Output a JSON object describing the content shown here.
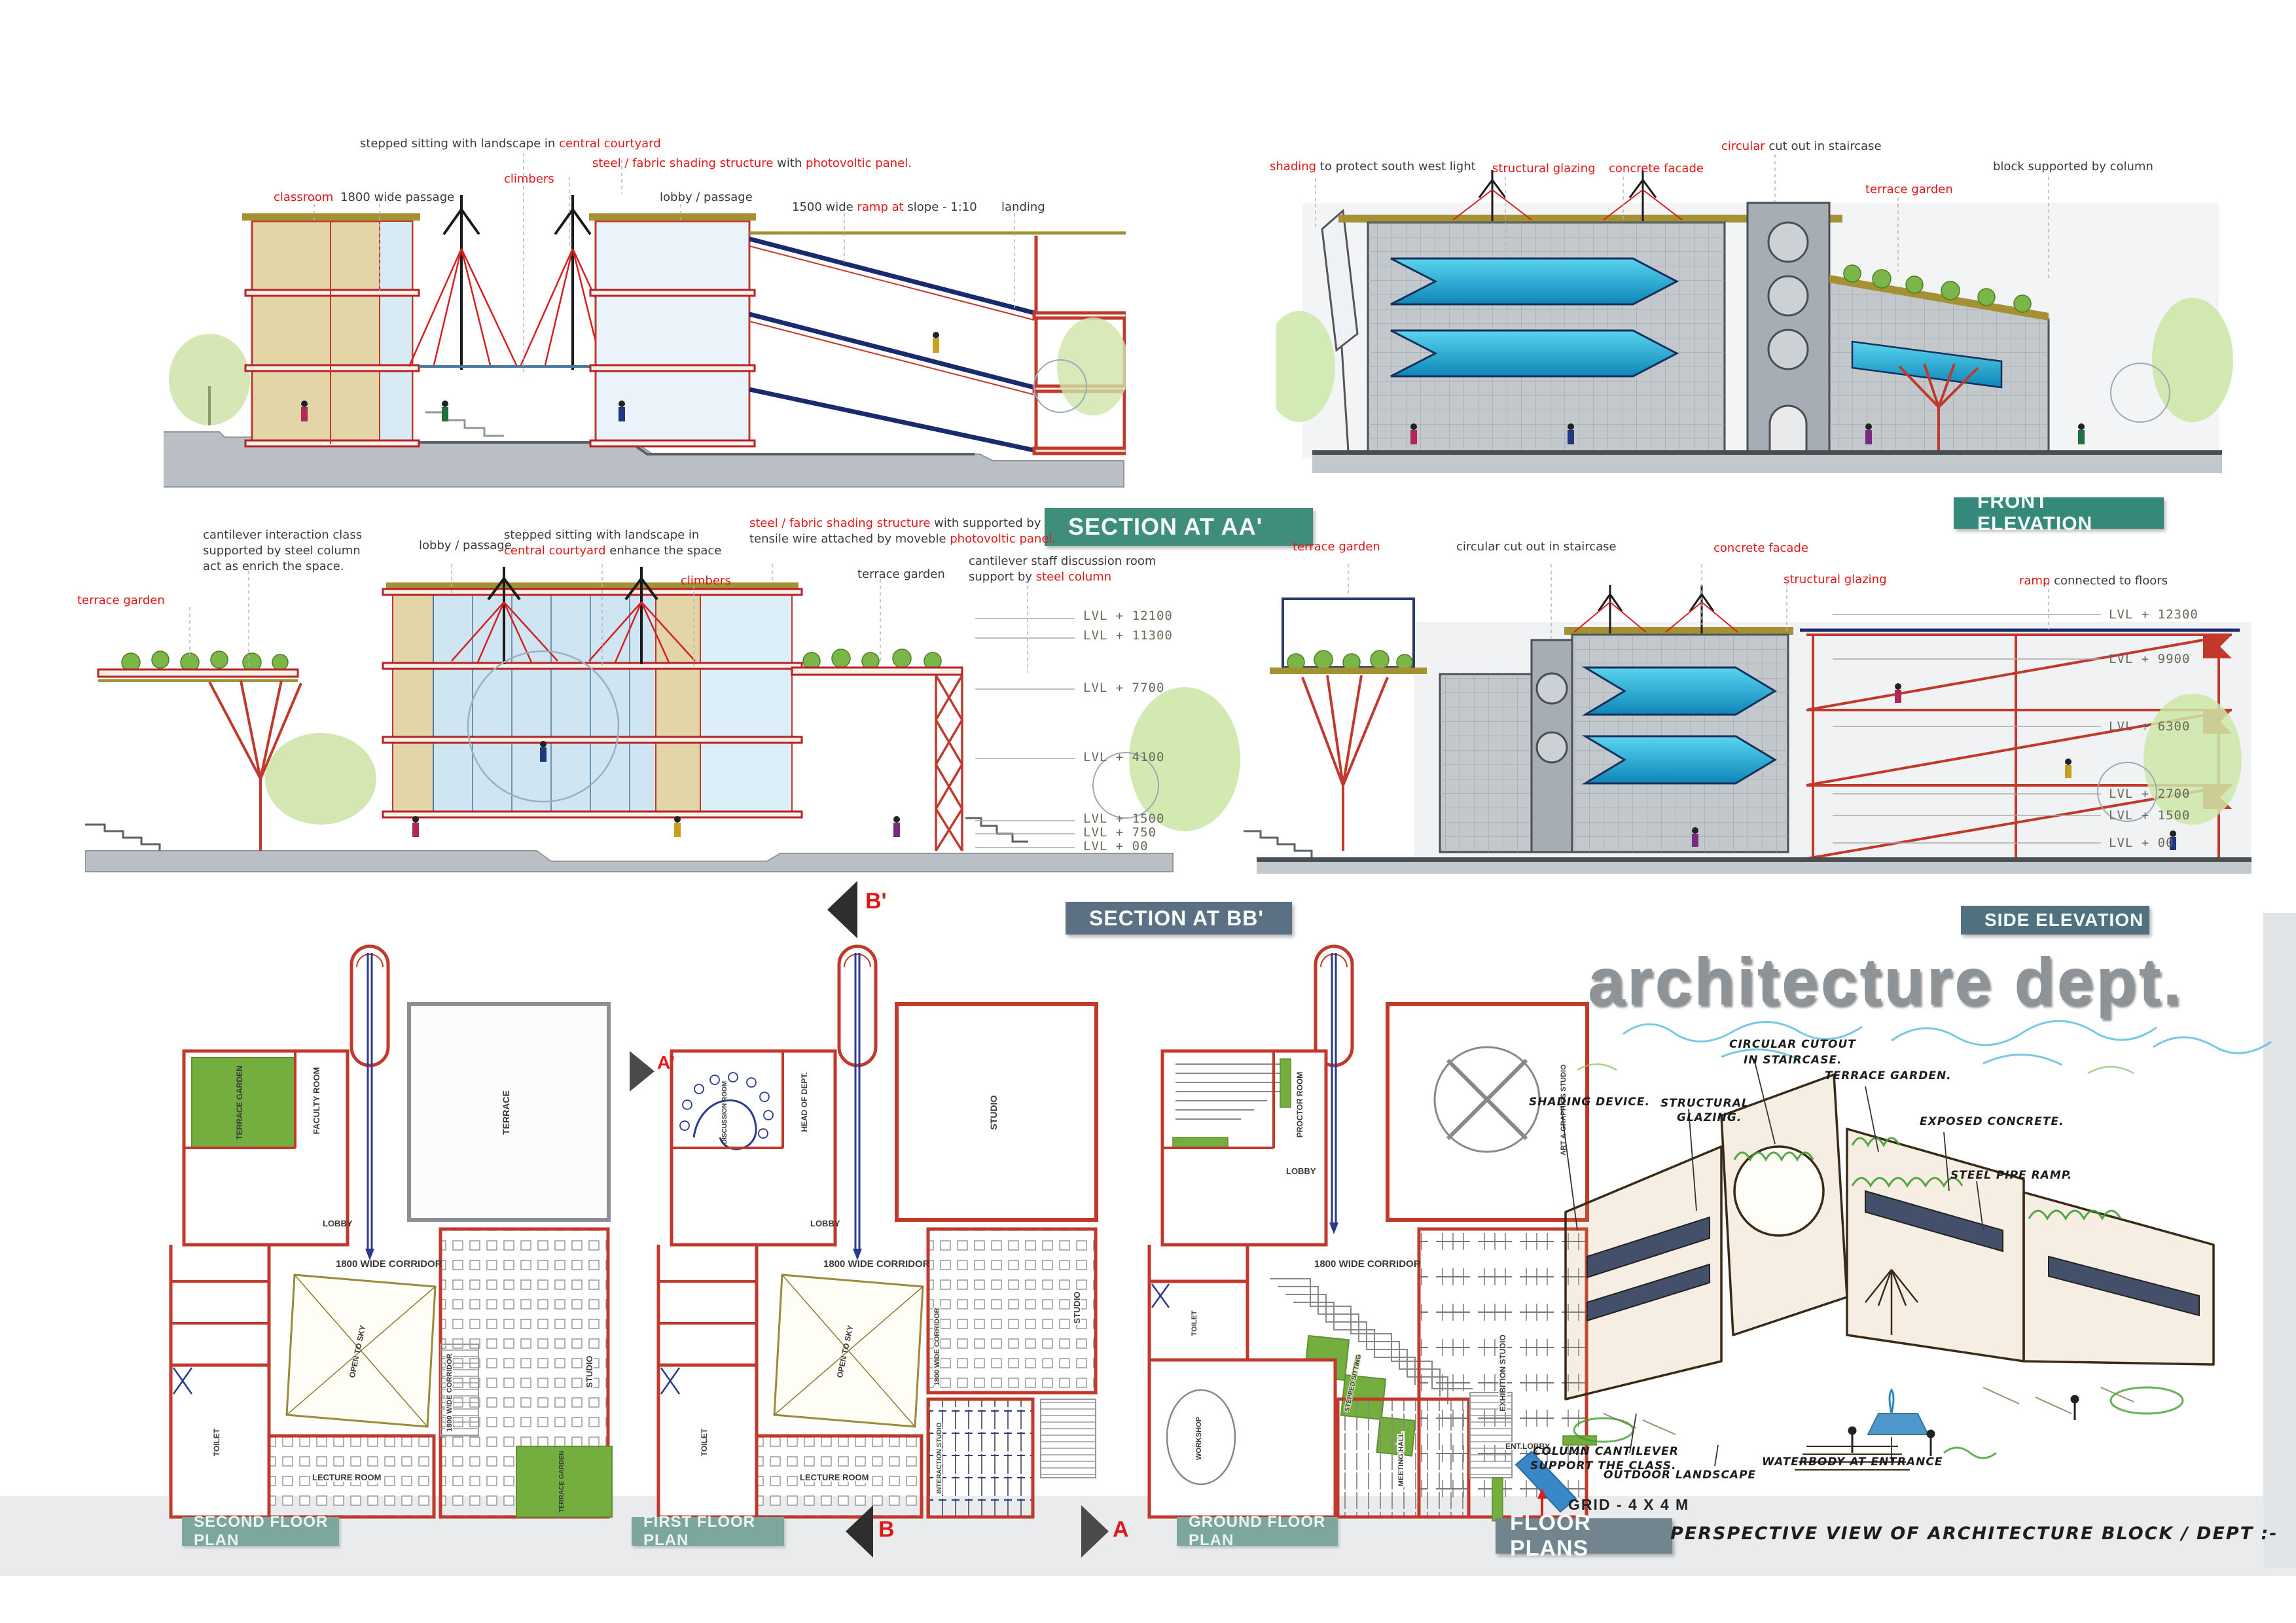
{
  "banners": {
    "section_aa": "SECTION AT AA'",
    "front_elevation": "FRONT ELEVATION",
    "section_bb": "SECTION AT BB'",
    "side_elevation": "SIDE ELEVATION",
    "floor_plans": "FLOOR PLANS"
  },
  "watermark": "architecture dept.",
  "colors": {
    "annotation_red": "#e01818",
    "wall_red": "#c0392b",
    "glazing_cyan": "#2bb4dc",
    "banner_teal": "#3f8e7c",
    "banner_slate": "#5b7183",
    "garden_green": "#74ae3e"
  },
  "section_aa": {
    "ann": {
      "stepped_pre": "stepped sitting with landscape in ",
      "stepped_red": "central courtyard",
      "steel_red1": "steel / fabric shading  structure",
      "steel_mid": " with ",
      "steel_red2": "photovoltic panel.",
      "climbers": "climbers",
      "classroom": "classroom",
      "passage": "1800 wide passage",
      "lobby": "lobby / passage",
      "ramp_pre": "1500 wide ",
      "ramp_red": "ramp at",
      "ramp_post": " slope - 1:10",
      "landing": "landing"
    }
  },
  "front_elevation": {
    "ann": {
      "shading_red": "shading",
      "shading_post": " to protect south west light",
      "structural_glazing": "structural glazing",
      "concrete_facade": "concrete facade",
      "circular_red": "circular",
      "circular_post": " cut out in staircase",
      "terrace_garden": "terrace garden",
      "block": "block supported by column"
    }
  },
  "section_bb": {
    "ann": {
      "cant1": "cantilever interaction class",
      "cant2": "supported by steel column",
      "cant3": "act as enrich the space.",
      "lobby": "lobby / passage",
      "stepped1": "stepped sitting with landscape in",
      "stepped_red": "central courtyard",
      "stepped_post": " enhance the space",
      "steel_red1": "steel / fabric shading  structure",
      "steel_mid": " with supported by",
      "steel2_pre": "tensile wire attached by moveble ",
      "steel_red2": "photovoltic panel.",
      "climbers": "climbers",
      "terrace_garden": "terrace garden",
      "staff1": "cantilever staff discussion room",
      "staff2_pre": "support by ",
      "staff2_red": "steel column",
      "terrace_garden_left": "terrace garden"
    },
    "levels": [
      "LVL  + 12100",
      "LVL  + 11300",
      "LVL  + 7700",
      "LVL  + 4100",
      "LVL  + 1500",
      "LVL  + 750",
      "LVL  + 00"
    ]
  },
  "side_elevation": {
    "ann": {
      "terrace_garden": "terrace garden",
      "circular": "circular cut out in staircase",
      "concrete_facade": "concrete facade",
      "structural_glazing": "structural glazing",
      "ramp_red": "ramp",
      "ramp_post": " connected to floors"
    },
    "levels": [
      "LVL  + 12300",
      "LVL  + 9900",
      "LVL  + 6300",
      "LVL  + 2700",
      "LVL  + 1500",
      "LVL  + 00"
    ]
  },
  "plans": {
    "second": {
      "title": "SECOND FLOOR PLAN",
      "rooms": {
        "terrace_garden_top": "TERRACE GARDEN",
        "faculty": "FACULTY ROOM",
        "terrace": "TERRACE",
        "lobby": "LOBBY",
        "corridor": "1800 WIDE CORRIDOR",
        "corridor_v": "1800 WIDE CORRIDOR",
        "open_sky": "OPEN TO SKY",
        "studio": "STUDIO",
        "lecture": "LECTURE ROOM",
        "toilet": "TOILET",
        "terrace_garden_bottom": "TERRACE GARDEN"
      }
    },
    "first": {
      "title": "FIRST FLOOR PLAN",
      "rooms": {
        "discussion": "DISCUSSION ROOM",
        "hod": "HEAD OF DEPT.",
        "studio_top": "STUDIO",
        "lobby": "LOBBY",
        "corridor": "1800 WIDE CORRIDOR",
        "corridor_v": "1800 WIDE CORRIDOR",
        "open_sky": "OPEN TO SKY",
        "studio": "STUDIO",
        "lecture": "LECTURE ROOM",
        "interaction": "INTERACTION STUDIO",
        "toilet": "TOILET"
      }
    },
    "ground": {
      "title": "GROUND FLOOR PLAN",
      "rooms": {
        "lobby": "LOBBY",
        "proctor": "PROCTOR ROOM",
        "art": "ART & GRAPHICS STUDIO",
        "corridor": "1800 WIDE CORRIDOR",
        "stepped": "STEPPED SITTING",
        "exhibition": "EXHIBITION STUDIO",
        "workshop": "WORKSHOP",
        "meeting": "MEETING HALL",
        "ent_lobby": "ENT.LOBBY",
        "toilet": "TOILET"
      }
    },
    "markers": {
      "b_top": "B'",
      "a_top": "A'",
      "b_bottom": "B",
      "a_bottom": "A"
    }
  },
  "sketch": {
    "ann": {
      "circular1": "CIRCULAR CUTOUT",
      "circular2": "IN STAIRCASE.",
      "terrace": "TERRACE GARDEN.",
      "structural1": "STRUCTURAL",
      "structural2": "GLAZING.",
      "shading": "SHADING DEVICE.",
      "exposed": "EXPOSED CONCRETE.",
      "steel_pipe": "STEEL PIPE RAMP.",
      "column1": "COLUMN CANTILEVER",
      "column2": "SUPPORT THE CLASS.",
      "outdoor": "OUTDOOR LANDSCAPE",
      "waterbody": "WATERBODY AT ENTRANCE"
    },
    "grid_note": "GRID - 4  X 4 M",
    "caption": "PERSPECTIVE  VIEW  OF  ARCHITECTURE  BLOCK / DEPT :-"
  }
}
